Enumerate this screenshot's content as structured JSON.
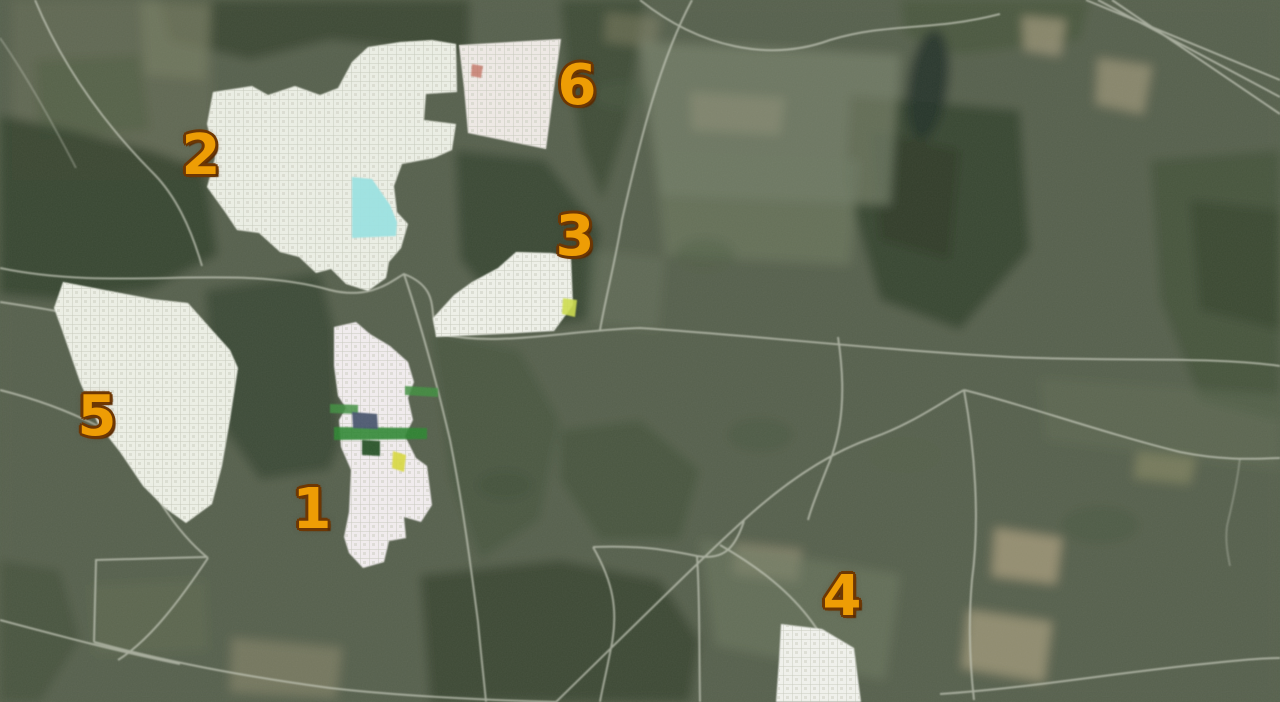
{
  "map": {
    "kind": "satellite-plot-map",
    "canvas": {
      "width": 1280,
      "height": 702
    },
    "colors": {
      "marker_fill": "#EE9D05",
      "marker_outline": "#6D3704",
      "terrain_base": "#57614D",
      "water": "#9BE3E3",
      "stripe_green": "#3F8F3F",
      "patch_navy": "#46536E",
      "patch_darkgreen": "#234F23",
      "patch_yellow": "#D8D83A"
    }
  },
  "markers": [
    {
      "label": "1",
      "x": 312,
      "y": 510
    },
    {
      "label": "2",
      "x": 201,
      "y": 156
    },
    {
      "label": "3",
      "x": 575,
      "y": 237
    },
    {
      "label": "4",
      "x": 842,
      "y": 597
    },
    {
      "label": "5",
      "x": 97,
      "y": 417
    },
    {
      "label": "6",
      "x": 577,
      "y": 86
    }
  ],
  "plot_areas": [
    {
      "name": "plot-area-2",
      "fill": "#EDF0E6",
      "points": "213,92 252,86 268,95 295,86 320,95 338,88 352,62 368,47 400,42 432,40 456,44 457,92 426,94 424,120 456,124 452,150 434,158 402,164 394,186 397,212 408,224 401,248 389,262 386,278 368,291 346,284 331,269 316,273 299,257 280,252 259,233 237,230 225,212 207,187 215,158 207,124"
    },
    {
      "name": "plot-area-6",
      "fill": "#F0EBE7",
      "points": "459,45 561,39 553,96 546,149 468,133 464,88"
    },
    {
      "name": "plot-area-3",
      "fill": "#F0F2EA",
      "points": "516,252 552,253 571,257 573,305 554,331 500,334 436,337 433,318 454,295 472,282 498,268"
    },
    {
      "name": "plot-area-5",
      "fill": "#EEF1E7",
      "points": "63,282 110,291 152,299 188,303 212,330 230,350 238,368 230,420 222,466 212,504 186,523 165,508 143,486 120,452 98,424 80,382 62,330 54,308"
    },
    {
      "name": "plot-area-1",
      "fill": "#F3EEF0",
      "points": "334,327 356,322 370,334 390,346 408,362 414,382 408,398 413,420 405,436 416,458 427,466 432,505 421,522 404,517 406,538 389,541 384,562 363,568 349,553 344,537 349,512 351,470 341,447 339,420 346,408 338,396 334,366"
    },
    {
      "name": "plot-area-4",
      "fill": "#F2F3EE",
      "points": "781,624 822,629 854,648 861,702 776,702 779,660"
    }
  ],
  "features": [
    {
      "name": "pond",
      "fill": "#9BE3E3",
      "opacity": 0.95,
      "points": "352,177 372,179 390,205 397,222 396,236 352,238"
    },
    {
      "name": "green-stripe-upper",
      "fill": "#3F8F3F",
      "opacity": 0.85,
      "points": "330,404 358,405 358,414 330,413"
    },
    {
      "name": "green-stripe-lower",
      "fill": "#2F8632",
      "opacity": 0.9,
      "points": "334,427 427,428 427,439 334,440"
    },
    {
      "name": "green-bar-east",
      "fill": "#3F8F3F",
      "opacity": 0.85,
      "points": "405,386 438,388 438,397 405,395"
    },
    {
      "name": "navy-patch",
      "fill": "#46536E",
      "opacity": 0.95,
      "points": "352,412 377,414 378,429 353,428"
    },
    {
      "name": "dark-green-square",
      "fill": "#234F23",
      "opacity": 0.95,
      "points": "362,440 380,441 380,456 362,455"
    },
    {
      "name": "yellow-patch-area1",
      "fill": "#D8D83A",
      "opacity": 0.9,
      "points": "393,451 406,455 404,472 392,468"
    },
    {
      "name": "yellow-patch-area3",
      "fill": "#CEDE4E",
      "opacity": 0.9,
      "points": "563,298 577,300 575,317 562,314"
    },
    {
      "name": "red-mark-area6",
      "fill": "#C06858",
      "opacity": 0.75,
      "points": "472,64 483,66 481,78 471,76"
    }
  ]
}
